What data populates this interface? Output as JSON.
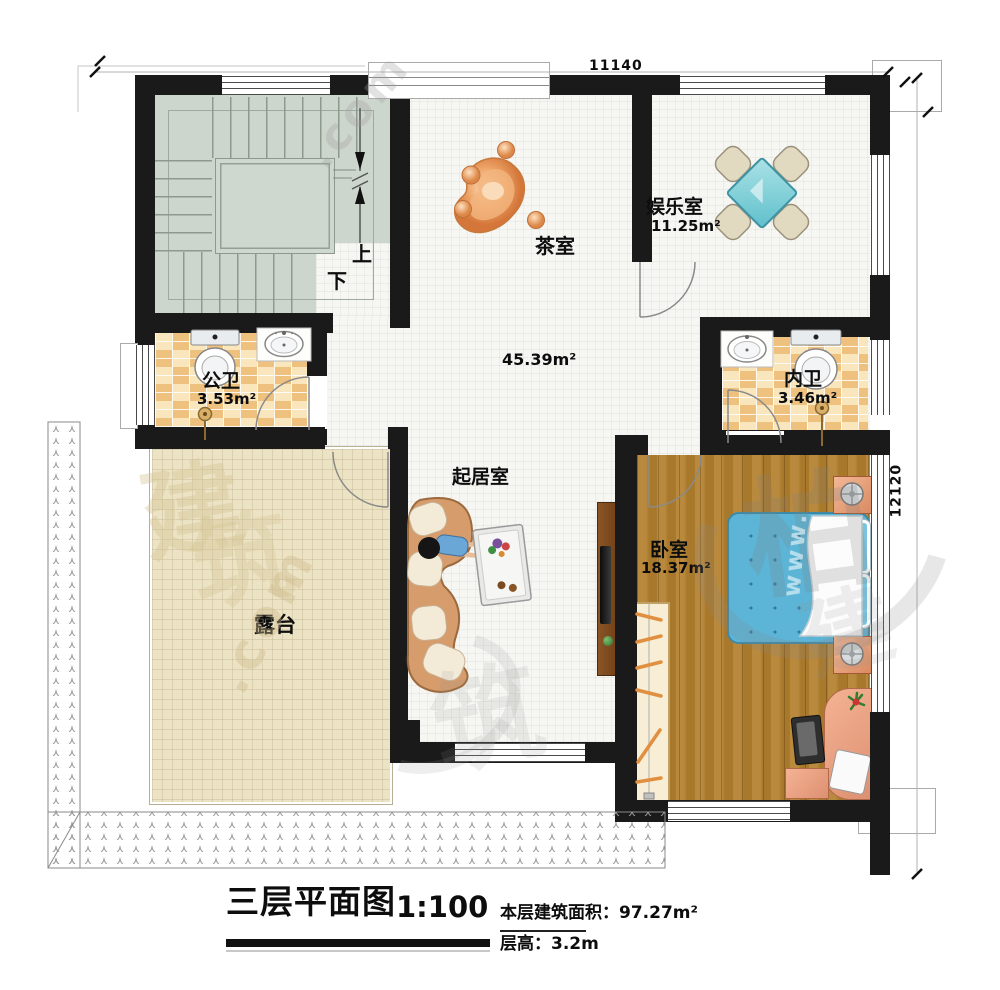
{
  "plan": {
    "dim_top": "11140",
    "dim_right": "12120",
    "stair_up": "上",
    "stair_down": "下",
    "rooms": {
      "entertainment": {
        "name": "娱乐室",
        "area": "11.25m²"
      },
      "tea": {
        "name": "茶室"
      },
      "hall": {
        "area": "45.39m²"
      },
      "living": {
        "name": "起居室"
      },
      "public_bath": {
        "name": "公卫",
        "area": "3.53m²"
      },
      "private_bath": {
        "name": "内卫",
        "area": "3.46m²"
      },
      "bedroom": {
        "name": "卧室",
        "area": "18.37m²"
      },
      "terrace": {
        "name": "露台"
      }
    }
  },
  "title_block": {
    "title": "三层平面图",
    "scale": "1:100",
    "area_text": "本层建筑面积：97.27m²",
    "height_text": "层高：3.2m"
  },
  "watermark": {
    "items": [
      "建",
      "筑",
      ".com",
      "柏",
      "www."
    ]
  },
  "colors": {
    "wall": "#1a1a1a",
    "stair_floor": "#cdd6cc",
    "bath_tile": "#eec17f",
    "wood_floor": "#b3802e",
    "terrace_floor": "#ebe3c4",
    "bed_blue": "#5cb5d7",
    "furniture_salmon": "#e8a083",
    "table_teal": "#7fd0d8",
    "table_orange": "#e89a5c"
  }
}
